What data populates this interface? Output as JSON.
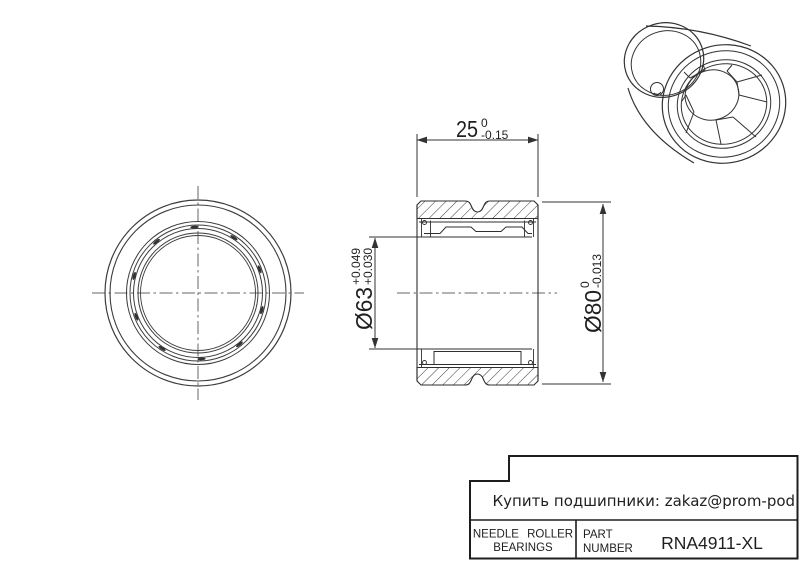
{
  "dimensions": {
    "width": {
      "value": "25",
      "tol_upper": "0",
      "tol_lower": "-0.15"
    },
    "bore": {
      "value": "Ø63",
      "tol_upper": "+0.049",
      "tol_lower": "+0.030"
    },
    "outer_diameter": {
      "value": "Ø80",
      "tol_upper": "0",
      "tol_lower": "-0.013"
    }
  },
  "title_block": {
    "contact": "Купить подшипники: zakaz@prom-pod.ru",
    "category_line1": "NEEDLE ROLLER",
    "category_line2": "BEARINGS",
    "part_label_line1": "PART",
    "part_label_line2": "NUMBER",
    "part_number": "RNA4911-XL"
  },
  "colors": {
    "line": "#333333",
    "background": "#ffffff"
  }
}
